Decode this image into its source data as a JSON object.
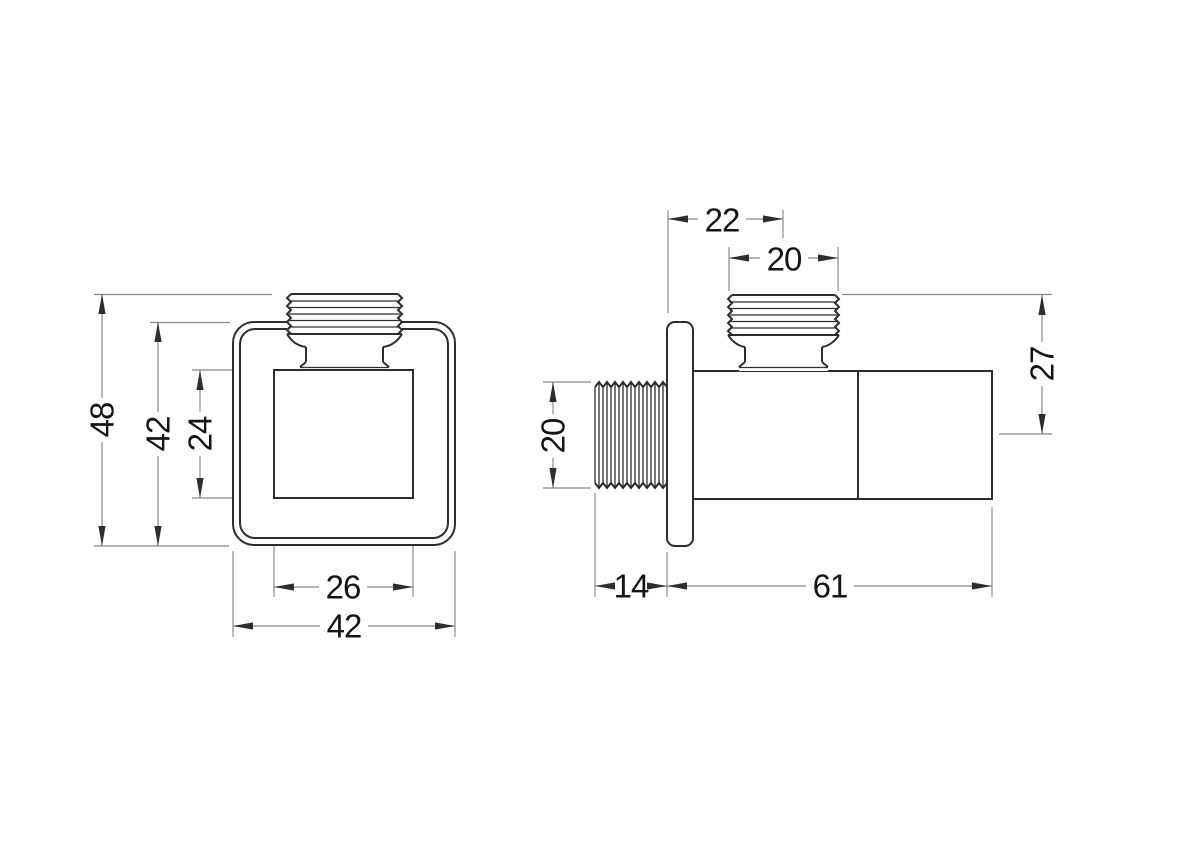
{
  "drawing": {
    "front_view": {
      "overall_height": "48",
      "plate_height": "42",
      "body_face_height": "24",
      "body_face_width": "26",
      "plate_width": "42"
    },
    "side_view": {
      "outlet_offset_from_wall": "22",
      "outlet_thread_width": "20",
      "inlet_thread_height": "20",
      "outlet_top_to_axis": "27",
      "inlet_thread_length": "14",
      "body_length": "61"
    },
    "colors": {
      "background": "#ffffff",
      "object_line": "#2d2d2d",
      "dimension_line": "#8a8a8a",
      "text": "#141414"
    }
  }
}
